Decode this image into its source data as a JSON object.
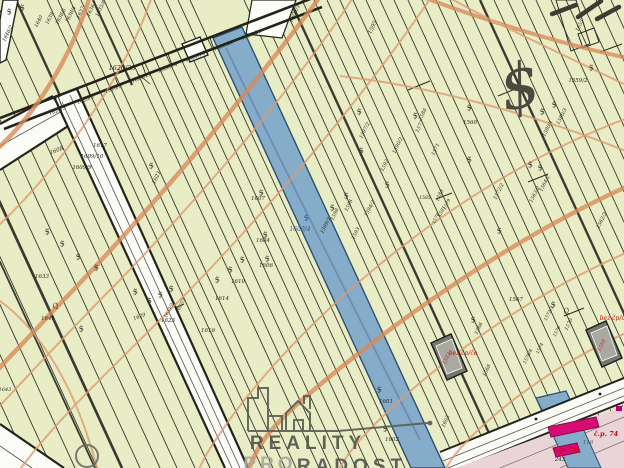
{
  "app": {
    "type": "cadastral-map-view",
    "watermark": {
      "brand_line1": "REALITY",
      "brand_line2": "PRO",
      "brand_line3": "RADOST"
    }
  },
  "map": {
    "colors": {
      "background": "#e9edc6",
      "water": "#85adc9",
      "water_edge": "#2e4f6e",
      "contour": "#dd9a70",
      "contour_bold": "#d88a58",
      "road": "#fbfbf7",
      "boundary": "#23231a",
      "pink_zone": "#e9d4d8",
      "building_gray": "#8f8f8f",
      "building_magenta": "#d60d72",
      "label": "#26261a",
      "label_red": "#d40000",
      "label_blue": "#2a5b8e"
    },
    "labels": [
      {
        "t": "1620/23",
        "x": 122,
        "y": 70,
        "r": 0,
        "s": 6.5
      },
      {
        "t": "1620/3",
        "x": 58,
        "y": 112,
        "r": -21,
        "s": 5
      },
      {
        "t": "1620/5",
        "x": 86,
        "y": 101,
        "r": -21,
        "s": 5
      },
      {
        "t": "1620/8",
        "x": 114,
        "y": 90,
        "r": -21,
        "s": 5
      },
      {
        "t": "1620/11",
        "x": 142,
        "y": 79,
        "r": -21,
        "s": 5
      },
      {
        "t": "1620/14",
        "x": 168,
        "y": 69,
        "r": -21,
        "s": 5
      },
      {
        "t": "1620/18",
        "x": 196,
        "y": 58,
        "r": -21,
        "s": 5
      },
      {
        "t": "1620/20",
        "x": 224,
        "y": 47,
        "r": -21,
        "s": 5
      },
      {
        "t": "1620/21",
        "x": 252,
        "y": 36,
        "r": -21,
        "s": 5
      },
      {
        "t": "1646/2",
        "x": 9,
        "y": 34,
        "r": -64,
        "s": 5
      },
      {
        "t": "1640",
        "x": 40,
        "y": 22,
        "r": -64,
        "s": 5
      },
      {
        "t": "1639",
        "x": 51,
        "y": 19,
        "r": -64,
        "s": 5
      },
      {
        "t": "1638/5",
        "x": 62,
        "y": 17,
        "r": -64,
        "s": 5
      },
      {
        "t": "1638/4",
        "x": 72,
        "y": 15,
        "r": -64,
        "s": 5
      },
      {
        "t": "1637",
        "x": 82,
        "y": 13,
        "r": -64,
        "s": 5
      },
      {
        "t": "1636",
        "x": 92,
        "y": 11,
        "r": -64,
        "s": 5
      },
      {
        "t": "1635/8",
        "x": 102,
        "y": 9,
        "r": -64,
        "s": 5
      },
      {
        "t": "1602/1",
        "x": 296,
        "y": 14,
        "r": -64,
        "s": 5.5
      },
      {
        "t": "1595",
        "x": 374,
        "y": 28,
        "r": -64,
        "s": 5.5
      },
      {
        "t": "1608",
        "x": 57,
        "y": 152,
        "r": -21,
        "s": 5.5
      },
      {
        "t": "1617",
        "x": 100,
        "y": 147,
        "r": 0,
        "s": 5.5
      },
      {
        "t": "1609/10",
        "x": 92,
        "y": 158,
        "r": 0,
        "s": 5.5
      },
      {
        "t": "1609/9",
        "x": 82,
        "y": 169,
        "r": 0,
        "s": 5.5
      },
      {
        "t": "1621",
        "x": 158,
        "y": 178,
        "r": -64,
        "s": 5.5
      },
      {
        "t": "1633",
        "x": 42,
        "y": 278,
        "r": 0,
        "s": 5.5
      },
      {
        "t": "1641",
        "x": 48,
        "y": 320,
        "r": 0,
        "s": 5.5
      },
      {
        "t": "1623",
        "x": 168,
        "y": 322,
        "r": 0,
        "s": 5.5
      },
      {
        "t": "1629",
        "x": 140,
        "y": 318,
        "r": -21,
        "s": 5
      },
      {
        "t": "1635/2",
        "x": 170,
        "y": 311,
        "r": -64,
        "s": 4.5
      },
      {
        "t": "1637/2",
        "x": 182,
        "y": 306,
        "r": -64,
        "s": 4.5
      },
      {
        "t": "1610",
        "x": 238,
        "y": 283,
        "r": 0,
        "s": 5.5
      },
      {
        "t": "1614",
        "x": 222,
        "y": 300,
        "r": 0,
        "s": 5.5
      },
      {
        "t": "1616",
        "x": 208,
        "y": 332,
        "r": 0,
        "s": 5.5
      },
      {
        "t": "1607",
        "x": 258,
        "y": 200,
        "r": 0,
        "s": 5.5
      },
      {
        "t": "1604",
        "x": 263,
        "y": 242,
        "r": 0,
        "s": 5.5
      },
      {
        "t": "1606",
        "x": 266,
        "y": 267,
        "r": 0,
        "s": 5.5
      },
      {
        "t": "1600/4",
        "x": 300,
        "y": 231,
        "r": 0,
        "s": 6,
        "c": "#2a5b8e"
      },
      {
        "t": "1598",
        "x": 336,
        "y": 215,
        "r": -64,
        "s": 5
      },
      {
        "t": "1599/2",
        "x": 327,
        "y": 226,
        "r": -64,
        "s": 5
      },
      {
        "t": "1596",
        "x": 350,
        "y": 206,
        "r": -64,
        "s": 5
      },
      {
        "t": "1594/2",
        "x": 371,
        "y": 209,
        "r": -64,
        "s": 5
      },
      {
        "t": "1593",
        "x": 357,
        "y": 234,
        "r": -64,
        "s": 5
      },
      {
        "t": "1597/2",
        "x": 366,
        "y": 131,
        "r": -64,
        "s": 5
      },
      {
        "t": "1592",
        "x": 386,
        "y": 166,
        "r": -64,
        "s": 5
      },
      {
        "t": "1590/2",
        "x": 399,
        "y": 146,
        "r": -64,
        "s": 5
      },
      {
        "t": "1588",
        "x": 424,
        "y": 115,
        "r": -64,
        "s": 5
      },
      {
        "t": "1586",
        "x": 441,
        "y": 196,
        "r": -64,
        "s": 5
      },
      {
        "t": "1577",
        "x": 421,
        "y": 127,
        "r": -64,
        "s": 5
      },
      {
        "t": "1571",
        "x": 437,
        "y": 150,
        "r": -64,
        "s": 5
      },
      {
        "t": "1560",
        "x": 470,
        "y": 124,
        "r": 0,
        "s": 5.5
      },
      {
        "t": "1559/2",
        "x": 578,
        "y": 82,
        "r": 0,
        "s": 5.5
      },
      {
        "t": "1555",
        "x": 581,
        "y": 26,
        "r": -64,
        "s": 5
      },
      {
        "t": "1580/1",
        "x": 549,
        "y": 129,
        "r": -64,
        "s": 5
      },
      {
        "t": "1580/3",
        "x": 563,
        "y": 117,
        "r": -64,
        "s": 5
      },
      {
        "t": "1564/2",
        "x": 546,
        "y": 184,
        "r": -64,
        "s": 5
      },
      {
        "t": "1563/2",
        "x": 536,
        "y": 195,
        "r": -64,
        "s": 5
      },
      {
        "t": "1562/2",
        "x": 603,
        "y": 221,
        "r": -64,
        "s": 5
      },
      {
        "t": "1572/2",
        "x": 500,
        "y": 192,
        "r": -64,
        "s": 5
      },
      {
        "t": "1579",
        "x": 448,
        "y": 205,
        "r": -64,
        "s": 4.5
      },
      {
        "t": "1581",
        "x": 443,
        "y": 212,
        "r": -64,
        "s": 4.5
      },
      {
        "t": "1585",
        "x": 425,
        "y": 199,
        "r": 0,
        "s": 4.5
      },
      {
        "t": "1578",
        "x": 437,
        "y": 219,
        "r": -64,
        "s": 4.5
      },
      {
        "t": "1567",
        "x": 516,
        "y": 301,
        "r": 0,
        "s": 5.5
      },
      {
        "t": "1570",
        "x": 570,
        "y": 325,
        "r": -64,
        "s": 5
      },
      {
        "t": "1572/3",
        "x": 550,
        "y": 314,
        "r": -64,
        "s": 4.5
      },
      {
        "t": "1574",
        "x": 541,
        "y": 349,
        "r": -64,
        "s": 4.5
      },
      {
        "t": "1576",
        "x": 558,
        "y": 332,
        "r": -64,
        "s": 4.5
      },
      {
        "t": "1578/4",
        "x": 529,
        "y": 357,
        "r": -64,
        "s": 4.5
      },
      {
        "t": "1566",
        "x": 480,
        "y": 329,
        "r": -64,
        "s": 5
      },
      {
        "t": "1568",
        "x": 488,
        "y": 371,
        "r": -64,
        "s": 5
      },
      {
        "t": "1601",
        "x": 386,
        "y": 403,
        "r": 0,
        "s": 5.5
      },
      {
        "t": "1602",
        "x": 392,
        "y": 441,
        "r": 0,
        "s": 5.5
      },
      {
        "t": "1603",
        "x": 447,
        "y": 422,
        "r": -64,
        "s": 5
      },
      {
        "t": "1643",
        "x": 5,
        "y": 391,
        "r": 0,
        "s": 5
      },
      {
        "t": "1583",
        "x": 448,
        "y": 359,
        "r": -64,
        "s": 5,
        "c": "#cc2222"
      },
      {
        "t": "1584",
        "x": 603,
        "y": 346,
        "r": -64,
        "s": 5,
        "c": "#cc2222"
      },
      {
        "t": "bez čp/če",
        "x": 463,
        "y": 355,
        "r": 0,
        "s": 6,
        "c": "#d40000"
      },
      {
        "t": "bez čp/če",
        "x": 614,
        "y": 320,
        "r": 0,
        "s": 6,
        "c": "#d40000"
      },
      {
        "t": "č.p. 74",
        "x": 606,
        "y": 436,
        "r": 0,
        "s": 6.5,
        "c": "#d40000",
        "b": 1
      },
      {
        "t": "č.p. 70",
        "x": 566,
        "y": 452,
        "r": 0,
        "s": 6.5,
        "c": "#d40000",
        "b": 1
      },
      {
        "t": "116",
        "x": 588,
        "y": 444,
        "r": 0,
        "s": 5.5,
        "c": "#55554c"
      },
      {
        "t": "243",
        "x": 560,
        "y": 461,
        "r": 0,
        "s": 5.5
      }
    ],
    "symbols": [
      {
        "x": 10,
        "y": 14
      },
      {
        "x": 23,
        "y": 10
      },
      {
        "x": 152,
        "y": 168
      },
      {
        "x": 48,
        "y": 234
      },
      {
        "x": 63,
        "y": 246
      },
      {
        "x": 79,
        "y": 259
      },
      {
        "x": 97,
        "y": 270
      },
      {
        "x": 136,
        "y": 294
      },
      {
        "x": 150,
        "y": 303
      },
      {
        "x": 161,
        "y": 297
      },
      {
        "x": 172,
        "y": 291
      },
      {
        "x": 82,
        "y": 331
      },
      {
        "x": 218,
        "y": 282
      },
      {
        "x": 231,
        "y": 272
      },
      {
        "x": 243,
        "y": 262
      },
      {
        "x": 262,
        "y": 195
      },
      {
        "x": 266,
        "y": 237
      },
      {
        "x": 268,
        "y": 261
      },
      {
        "x": 307,
        "y": 220,
        "c": "#2a5b8e"
      },
      {
        "x": 333,
        "y": 210
      },
      {
        "x": 347,
        "y": 198
      },
      {
        "x": 362,
        "y": 153
      },
      {
        "x": 360,
        "y": 114
      },
      {
        "x": 388,
        "y": 187
      },
      {
        "x": 416,
        "y": 118
      },
      {
        "x": 470,
        "y": 110
      },
      {
        "x": 470,
        "y": 162
      },
      {
        "x": 531,
        "y": 167
      },
      {
        "x": 541,
        "y": 170
      },
      {
        "x": 543,
        "y": 114
      },
      {
        "x": 555,
        "y": 107
      },
      {
        "x": 500,
        "y": 233
      },
      {
        "x": 592,
        "y": 70
      },
      {
        "x": 380,
        "y": 392
      },
      {
        "x": 386,
        "y": 431
      },
      {
        "x": 554,
        "y": 307
      },
      {
        "x": 474,
        "y": 322
      },
      {
        "x": 524,
        "y": 107,
        "s": 62,
        "r": -12,
        "c": "#4a4a41",
        "g": "$"
      },
      {
        "x": 56,
        "y": 308,
        "g": "Q",
        "s": 7
      },
      {
        "x": 567,
        "y": 313,
        "g": "Q",
        "s": 7
      }
    ]
  }
}
